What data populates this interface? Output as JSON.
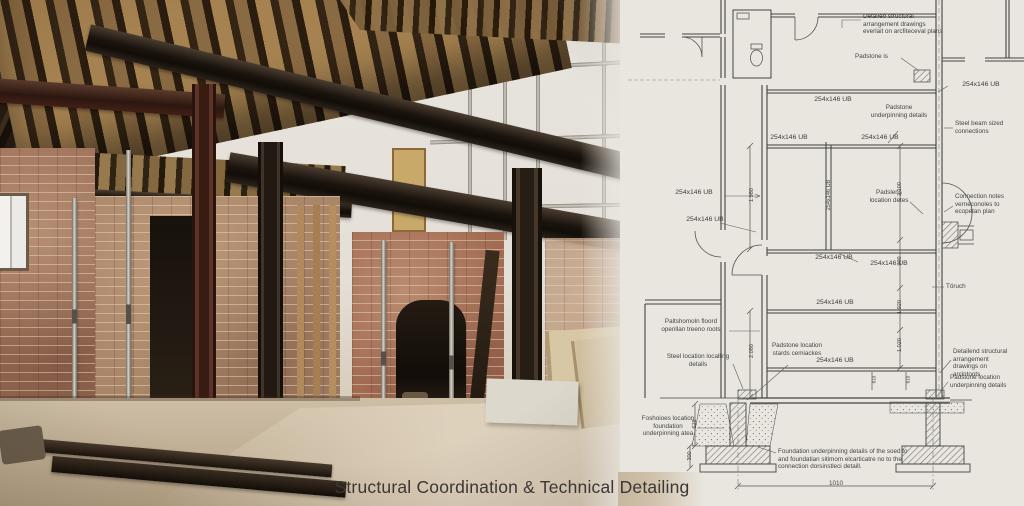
{
  "caption": "Structural Coordination & Technical Detailing",
  "drawing": {
    "beam_size": "254x146 UB",
    "beam_size_vertical": "254x146 UB",
    "annotations": {
      "detailed_top": "Detailed structural arrangement drawings everlait on arcfiteceval plans",
      "padstone_is": "Padstone is",
      "padstone_underpinning": "Padstone underpinning details",
      "steel_beam_sized": "Steel beam sized connections",
      "connection_notes": "Connection notes verneconoles to ecopetan plan",
      "padslens_location": "Padslens location detes",
      "toruch": "Töruch",
      "floor_note": "Paltshomoln floord openllan treeno roots",
      "steel_location": "Steel location localling details",
      "padstone_stards": "Padstone location stards cemiackes",
      "detailed_bottom": "Detailend structural arrangement drawings on arcintoots",
      "padstone_loc_underpinning": "Padstone location underpinning details",
      "foundation_area": "Foshoioes location foundation underpinning atea",
      "foundation_note": "Foundation underpinning details of the soed to and foundatian sitimom elcarticatre no to the connection dorsinstleci detaill."
    },
    "dimensions": {
      "d2100": "2.100",
      "d900": "900",
      "d1920": "1.920",
      "d1020": "1.020",
      "d1980": "1.980",
      "d2080": "2.080",
      "d628": "628",
      "d300": "300",
      "d610": "610",
      "d1010": "1010"
    }
  },
  "colors": {
    "paper": "#e9e6e0",
    "ink": "#3f3e3a",
    "steel_dark": "#241c15",
    "steel_maroon": "#4c2a20",
    "brick": "#9c7058",
    "floor": "#c8b9a2",
    "caption_text": "#3a3734"
  }
}
